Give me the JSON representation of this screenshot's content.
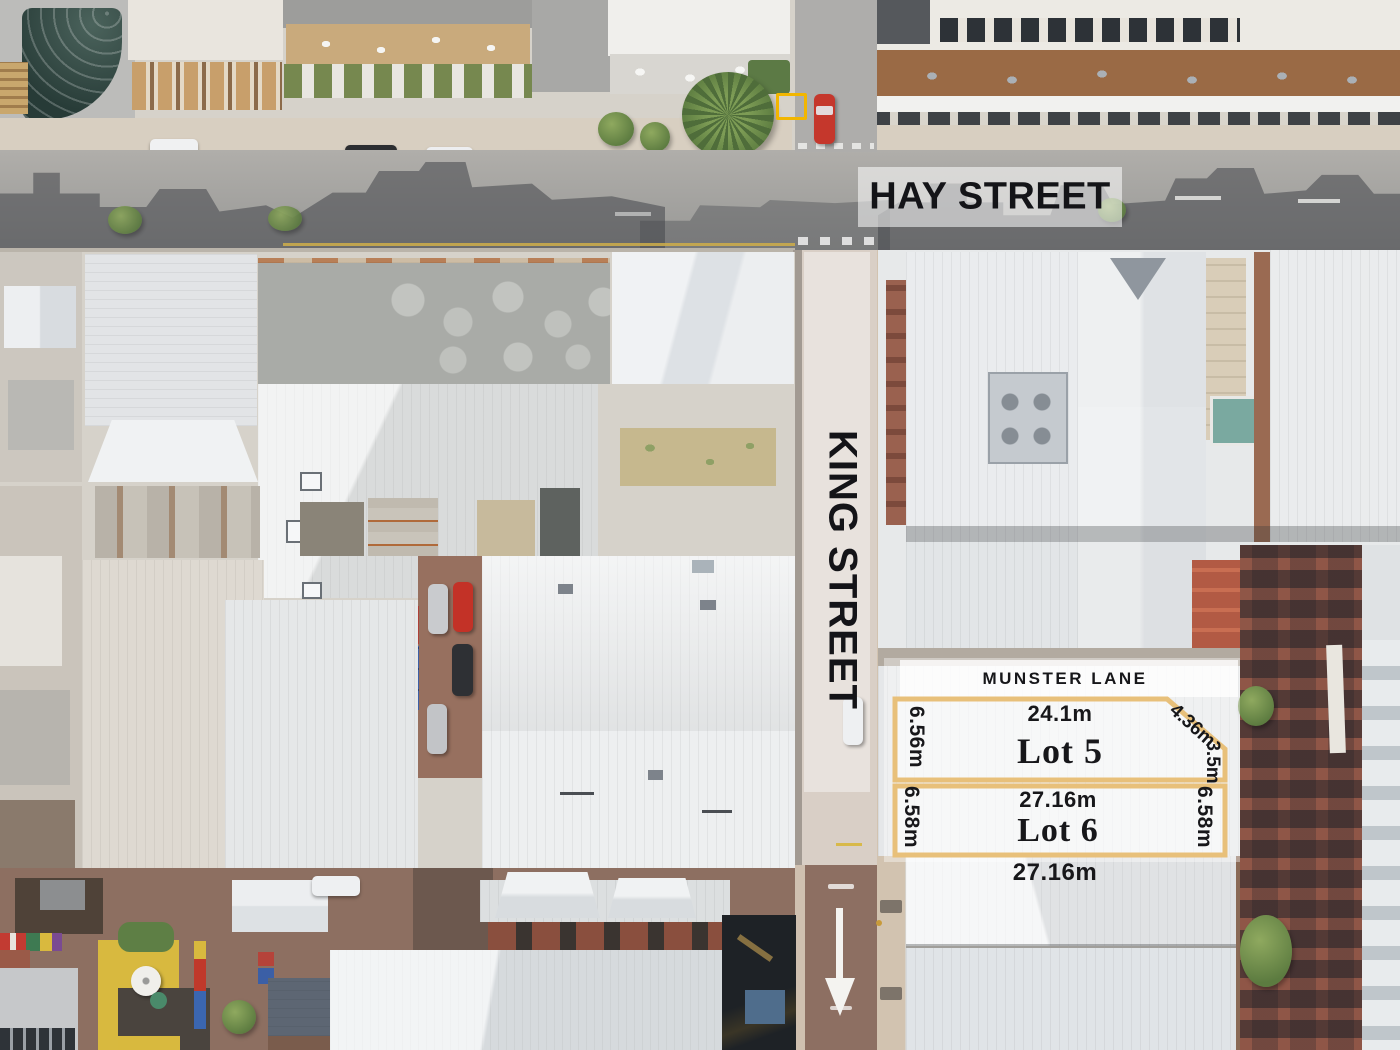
{
  "streets": {
    "hay": "HAY STREET",
    "king": "KING STREET",
    "munster": "MUNSTER LANE"
  },
  "lot5": {
    "name": "Lot 5",
    "top": "24.1m",
    "left": "6.56m",
    "diagonal": "4.36m",
    "right": "3.5m"
  },
  "lot6": {
    "name": "Lot 6",
    "top": "27.16m",
    "left": "6.58m",
    "right": "6.58m",
    "bottom": "27.16m"
  },
  "colors": {
    "lot_border": "#e8c07a",
    "lot_fill": "rgba(255,255,255,0.5)",
    "backdrop_fill": "rgba(255,255,255,0.38)",
    "highlight_square": "#f2b600",
    "street_label_text": "#16161a",
    "road_arrow": "#f4f3f0"
  }
}
